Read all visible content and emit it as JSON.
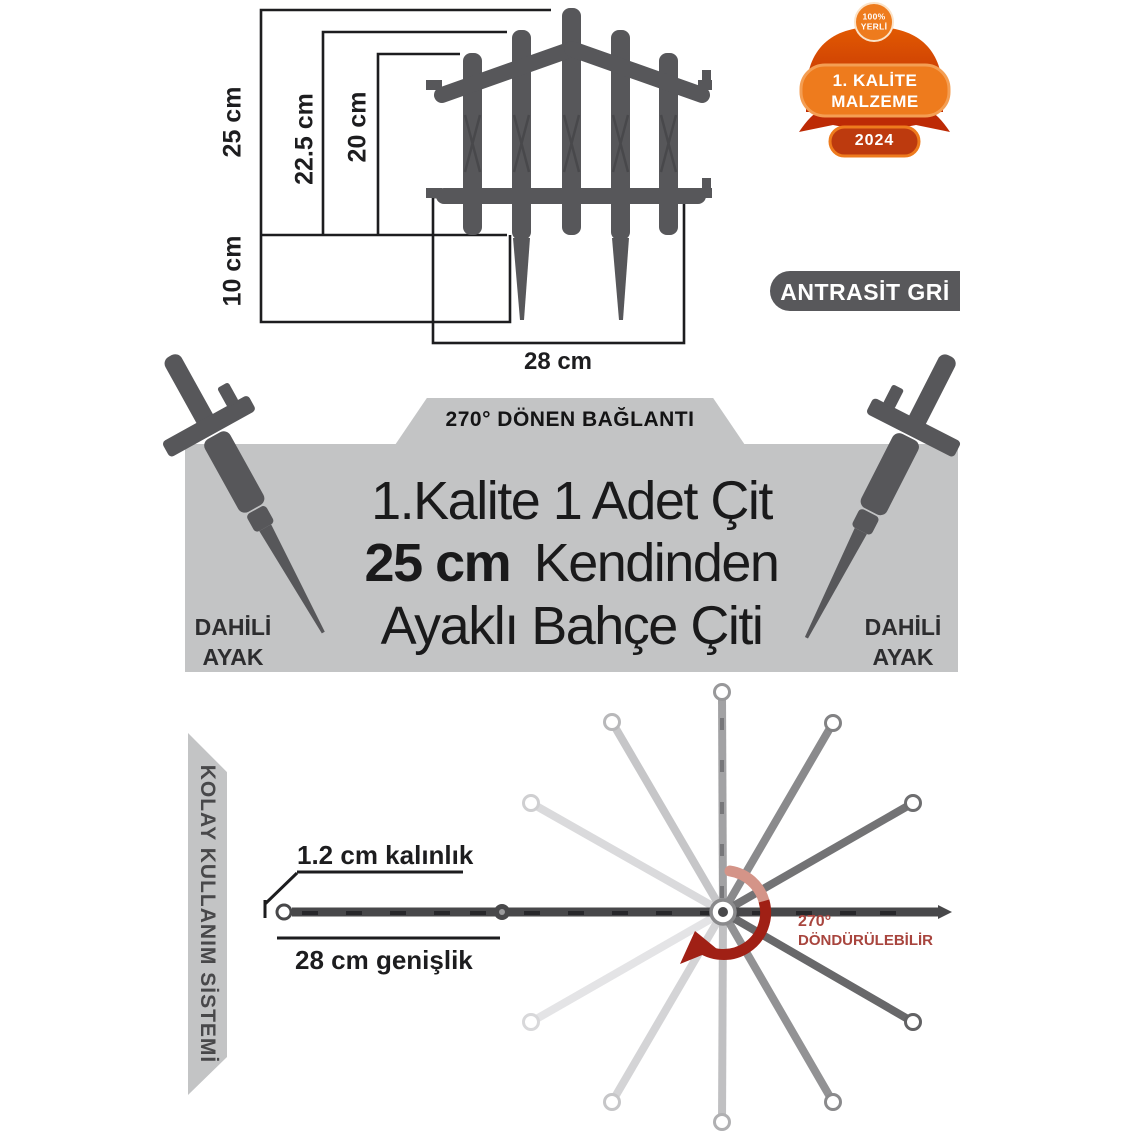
{
  "diagram": {
    "dim_25": "25 cm",
    "dim_22_5": "22.5 cm",
    "dim_20": "20 cm",
    "dim_10": "10 cm",
    "dim_28": "28 cm"
  },
  "badge": {
    "circle_line1": "100%",
    "circle_line2": "YERLİ",
    "plaque_line1": "1. KALİTE",
    "plaque_line2": "MALZEME",
    "year": "2024",
    "orange": "#ee7b1d",
    "dark_red": "#bd2a05"
  },
  "color_label": {
    "text": "ANTRASİT GRİ",
    "bg": "#58585b"
  },
  "banner": {
    "tab_label": "270° DÖNEN BAĞLANTI",
    "title_line1": "1.Kalite 1 Adet Çit",
    "title_line2_bold": "25 cm",
    "title_line2_rest": "Kendinden",
    "title_line3": "Ayaklı Bahçe Çiti",
    "left_leg_line1": "DAHİLİ",
    "left_leg_line2": "AYAK",
    "right_leg_line1": "DAHİLİ",
    "right_leg_line2": "AYAK",
    "bg": "#c3c4c5",
    "fence_gray": "#57575a"
  },
  "usage": {
    "ribbon_label": "KOLAY KULLANIM SİSTEMİ",
    "thickness_label": "1.2 cm kalınlık",
    "width_label": "28 cm genişlik",
    "rotation_deg": "270°",
    "rotation_label": "DÖNDÜRÜLEBİLİR",
    "accent_red": "#a02015"
  }
}
